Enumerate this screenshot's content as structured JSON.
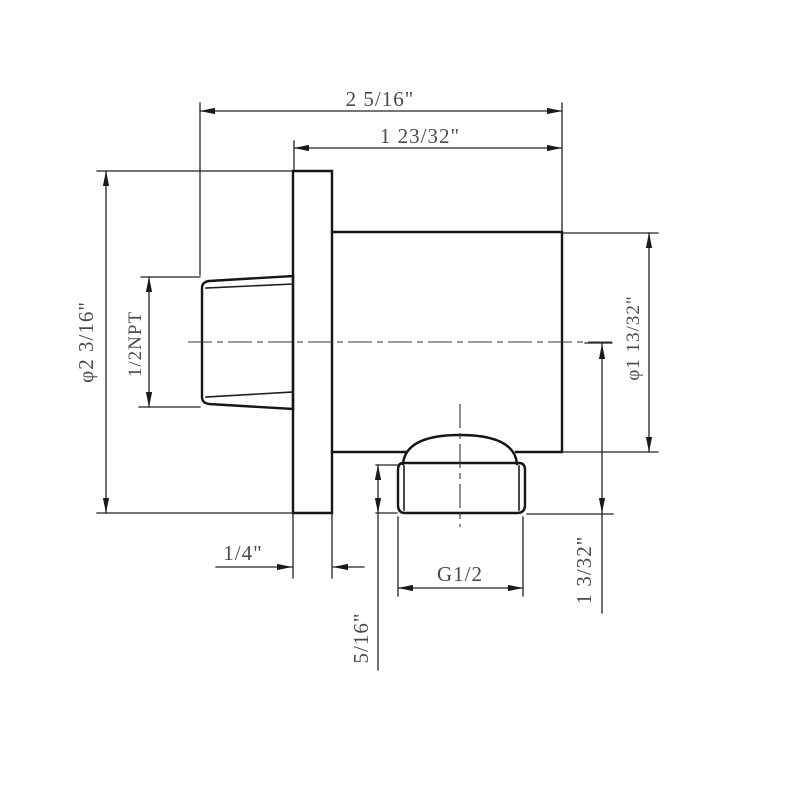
{
  "drawing": {
    "type": "engineering-dimension-drawing",
    "subject": "wall-mounted shower outlet elbow, side view",
    "colors": {
      "background": "#ffffff",
      "object_line": "#161616",
      "dimension_line": "#242424",
      "text": "#4a4a4a"
    },
    "labels": {
      "overall_depth": "2 5/16\"",
      "depth_from_wall": "1 23/32\"",
      "flange_diameter": "φ2 3/16\"",
      "inlet_thread": "1/2NPT",
      "body_diameter": "φ1 13/32\"",
      "flange_thickness": "1/4\"",
      "nut_height": "5/16\"",
      "outlet_thread": "G1/2",
      "center_to_nut_bottom": "1 3/32\""
    }
  }
}
